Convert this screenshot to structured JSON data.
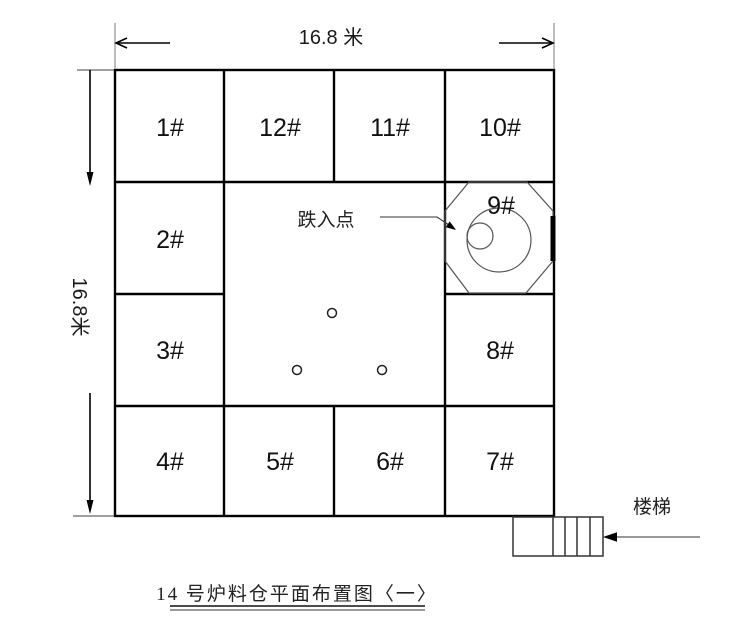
{
  "figure": {
    "caption": "14 号炉料仓平面布置图〈一〉",
    "dimension_top": "16.8 米",
    "dimension_left": "16.8米",
    "drop_point_label": "跌入点",
    "stairs_label": "楼梯",
    "cells": {
      "r1c1": "1#",
      "r1c2": "12#",
      "r1c3": "11#",
      "r1c4": "10#",
      "r2c1": "2#",
      "r2c4": "9#",
      "r3c1": "3#",
      "r3c4": "8#",
      "r4c1": "4#",
      "r4c2": "5#",
      "r4c3": "6#",
      "r4c4": "7#"
    },
    "colors": {
      "grid_line": "#000000",
      "thin_line": "#555555",
      "background": "#ffffff"
    }
  }
}
